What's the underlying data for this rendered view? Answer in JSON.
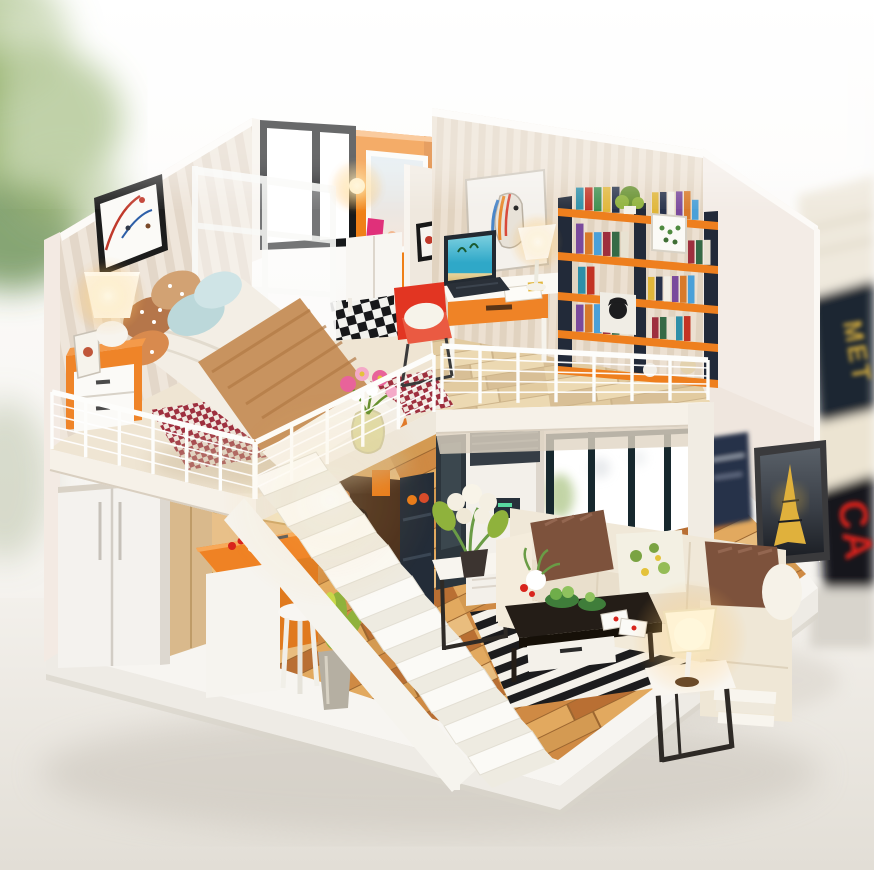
{
  "meta": {
    "description": "Photograph of a miniature DIY dollhouse: a two-story loft apartment with bedroom and study upstairs, kitchen and living room downstairs, connected by a white open staircase, set on a white table with blurred plant and books in the background."
  },
  "background": {
    "book_spine_top": "MET",
    "book_spine_red": "CA"
  },
  "palette": {
    "bg_top": "#ffffff",
    "bg_bottom": "#edeae5",
    "table": "#f2efea",
    "table_dark": "#e4e0d9",
    "shadow": "#b8b1a6",
    "leaf_green": "#7fa24f",
    "leaf_dark": "#55803a",
    "book_navy": "#1f2533",
    "book_gold": "#c9a43e",
    "book_cream": "#ece4d2",
    "book_red": "#d8241c",
    "book_dark": "#14161f",
    "wall_white": "#f6f1ea",
    "wall_pink": "#f3eae3",
    "stripe_a": "#efe6db",
    "stripe_b": "#e3d7c9",
    "ostripe_a": "#ece0d1",
    "ostripe_b": "#e1d3c0",
    "orange_wall": "#ef8018",
    "orange_deep": "#d96c0e",
    "accent_orange": "#ef8226",
    "orange_light": "#f59d4e",
    "window_black": "#17191b",
    "glass": "#ffffff",
    "partition": "#fafaf8",
    "checker_dark": "#17181a",
    "checker_light": "#f2f2ee",
    "loft_floor": "#efe5d3",
    "loft_warm": "#e7d6b4",
    "fascia": "#f6f1e8",
    "fascia_shade": "#e0d5c3",
    "railing": "#fdfdfb",
    "duvet": "#f3eee5",
    "duvet_fold": "#e2dbce",
    "blanket": "#c8935f",
    "blanket_deep": "#b27a45",
    "pillow_blue": "#bcd8da",
    "pillow_blue2": "#cfe4e6",
    "pillow_brown": "#b5764a",
    "pillow_tan": "#d2a273",
    "rug_red": "#9e2f3e",
    "rug_cream": "#f1e8df",
    "stair_white": "#fbfaf6",
    "stair_shade": "#eeebe1",
    "wood_a": "#e2a95f",
    "wood_b": "#cf8a44",
    "wood_c": "#b96f33",
    "wood_d": "#e9bd7e",
    "wood_e": "#d49a52",
    "wood_gap": "#9c6630",
    "fridge": "#f4f2ee",
    "cabinet_wood": "#d9b98c",
    "cabinet_panel": "#f2e3c2",
    "island_orange": "#ef8224",
    "island_white": "#f6f4ef",
    "pantry_navy": "#232c38",
    "stove_dark": "#4a2f1c",
    "plant_green": "#8fb23c",
    "plant_dark": "#66902e",
    "pot_gray": "#b5afa2",
    "ac_white": "#f3f0ea",
    "ac_grille": "#353d45",
    "ac_display": "#26303a",
    "sofa_cream": "#f0e8d8",
    "sofa_shade": "#e4d8c4",
    "sofa_deep": "#d9cbb2",
    "cushion_brown": "#7d523c",
    "cushion_hi": "#936650",
    "floral_cream": "#f3f0e3",
    "floral_green": "#7aa342",
    "floral_yellow": "#e4c23a",
    "coffee_dark": "#241d17",
    "coffee_deeper": "#161008",
    "drawer_white": "#f4f1ea",
    "rug_black": "#1c1c1e",
    "rug_white": "#f4f1ea",
    "metal_dark": "#2e2a26",
    "lamp_glow": "#ffcf7a",
    "lamp_core": "#fff3d0",
    "lamp_shade": "#fdf7e8",
    "eiffel_frame": "#3a3a3c",
    "eiffel_sky": "#596068",
    "eiffel_dark": "#1b1e24",
    "eiffel_gold": "#e0b13c",
    "poster_navy": "#26324a",
    "red_chair": "#e23522",
    "laptop_dark": "#232a32",
    "screen_teal": "#2fa8c8",
    "screen_light": "#7cd0e0",
    "sand": "#e8d49a",
    "desk_white": "#fbf9f4",
    "shelf_orange": "#ee7f1e",
    "shelf_navy": "#222a39",
    "che_white": "#f0ede5",
    "che_black": "#1d1d1f",
    "stitch_green": "#4e8a3e",
    "horse_blue": "#4a86c8",
    "horse_orange": "#e88a2e",
    "horse_red": "#d84a3a",
    "vase_glass": "#ded89e",
    "flower_pink": "#e8639a",
    "flower_pink2": "#f4aac8",
    "white": "#ffffff"
  },
  "railings": {
    "wire_count": 4,
    "segments": [
      {
        "posts": 6,
        "base": [
          52,
          449,
          254,
          499
        ],
        "top": [
          52,
          392,
          254,
          442
        ]
      },
      {
        "posts": 5,
        "base": [
          256,
          499,
          434,
          412
        ],
        "top": [
          256,
          442,
          434,
          355
        ]
      },
      {
        "posts": 7,
        "base": [
          442,
          404,
          708,
          400
        ],
        "top": [
          442,
          346,
          708,
          360
        ]
      }
    ]
  },
  "stairs": {
    "count": 10,
    "start": [
      252,
      478
    ],
    "step_dx": 24,
    "step_dy": 31,
    "tread_dx": 64,
    "tread_dy": -26,
    "side_dx": 12,
    "side_dy": 18
  },
  "bookshelf": {
    "left_x": 558,
    "slope": 0.088,
    "book_colors": [
      "#2e8fa8",
      "#c23324",
      "#3f8f4f",
      "#e0b63a",
      "#27324a",
      "#f2efe6",
      "#7a4a9c",
      "#d87a2a",
      "#4aa0d8",
      "#9e2f3e",
      "#356a46",
      "#e8e2d2"
    ],
    "rows": [
      {
        "x": 576,
        "shelf_y": 208,
        "count": 5,
        "w": 9,
        "h": 26
      },
      {
        "x": 652,
        "shelf_y": 208,
        "count": 6,
        "w": 8,
        "h": 24
      },
      {
        "x": 576,
        "shelf_y": 252,
        "count": 6,
        "w": 9,
        "h": 26
      },
      {
        "x": 688,
        "shelf_y": 252,
        "count": 3,
        "w": 8,
        "h": 24
      },
      {
        "x": 578,
        "shelf_y": 292,
        "count": 2,
        "w": 9,
        "h": 24
      },
      {
        "x": 648,
        "shelf_y": 292,
        "count": 6,
        "w": 8,
        "h": 25
      },
      {
        "x": 576,
        "shelf_y": 330,
        "count": 6,
        "w": 9,
        "h": 25
      },
      {
        "x": 652,
        "shelf_y": 330,
        "count": 5,
        "w": 8,
        "h": 24
      }
    ]
  }
}
